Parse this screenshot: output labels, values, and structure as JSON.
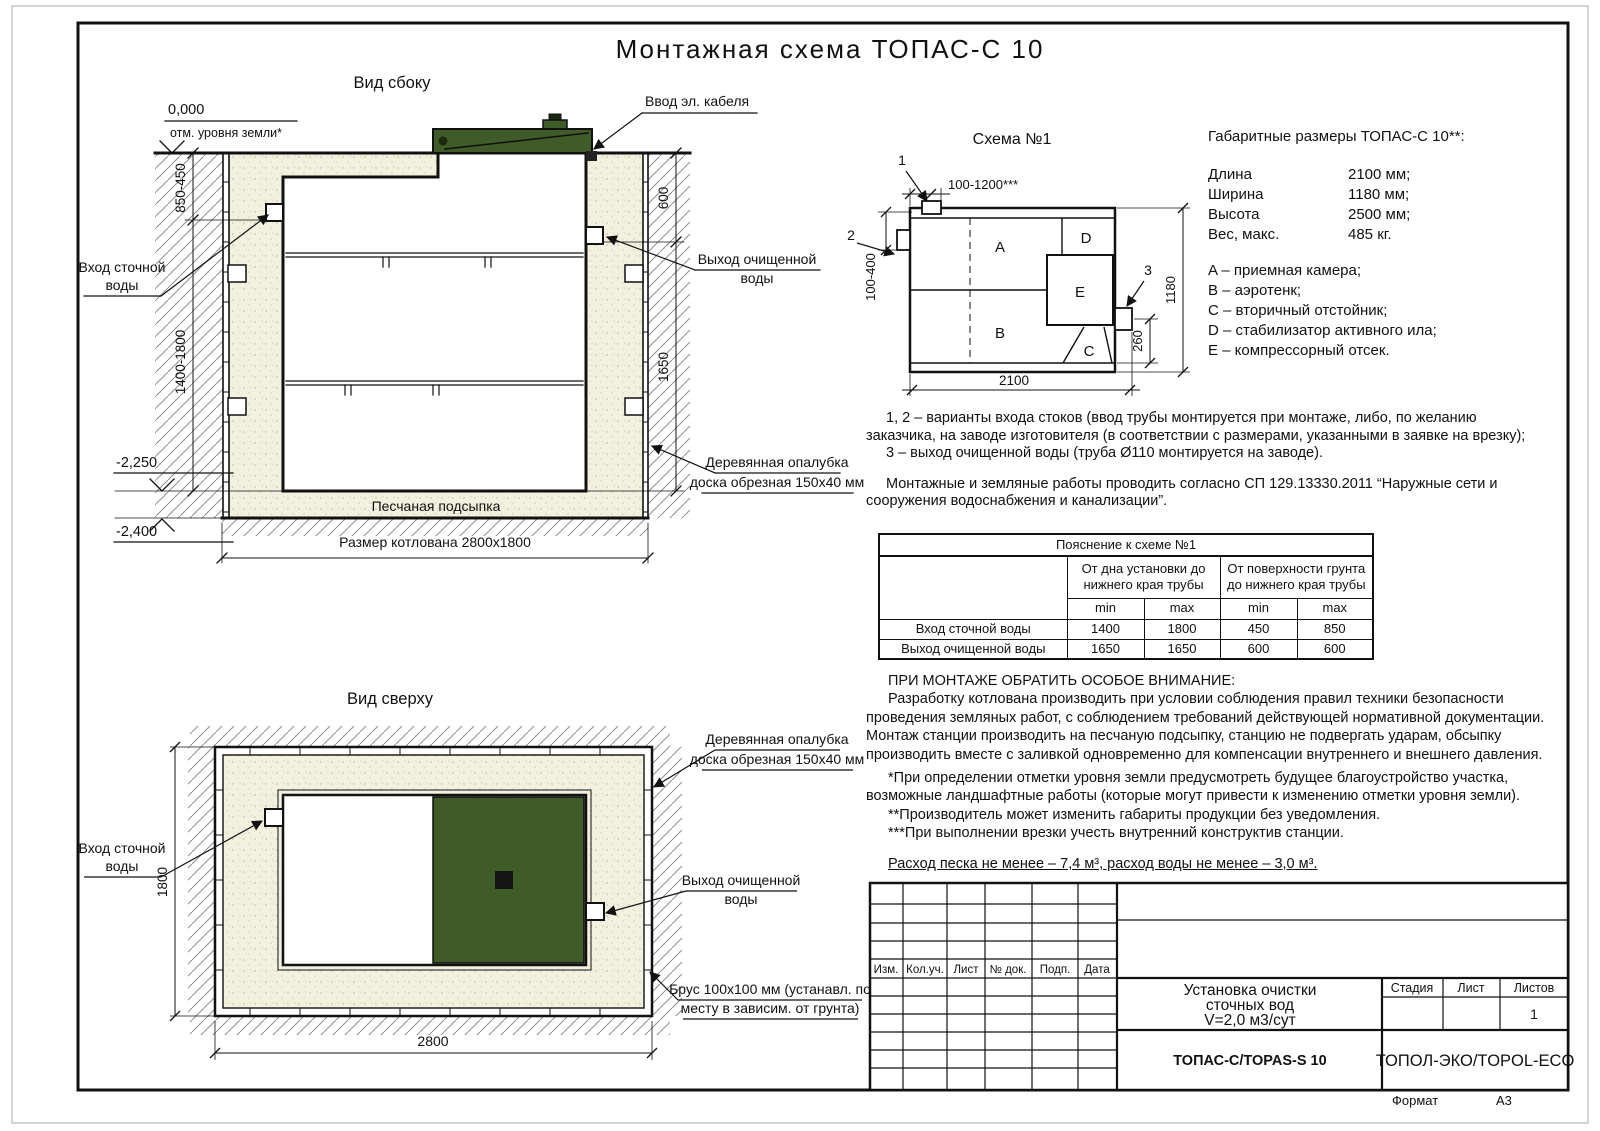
{
  "sheet": {
    "title": "Монтажная схема ТОПАС-С 10",
    "format_label": "Формат",
    "format_value": "А3"
  },
  "sv": {
    "title": "Вид сбоку",
    "elev0": "0,000",
    "elev0_note": "отм. уровня земли*",
    "dim_inlet": "850-450",
    "dim_body": "1400-1800",
    "elev_sand": "-2,250",
    "elev_pit": "-2,400",
    "dim600": "600",
    "dim1650": "1650",
    "inlet1": "Вход сточной",
    "inlet2": "воды",
    "cable": "Ввод эл. кабеля",
    "outlet1": "Выход очищенной",
    "outlet2": "воды",
    "formwork1": "Деревянная опалубка",
    "formwork2": "доска обрезная 150x40 мм",
    "sand": "Песчаная подсыпка",
    "pit": "Размер котлована 2800x1800"
  },
  "tv": {
    "title": "Вид сверху",
    "inlet1": "Вход сточной",
    "inlet2": "воды",
    "formwork1": "Деревянная опалубка",
    "formwork2": "доска обрезная 150x40 мм",
    "outlet1": "Выход очищенной",
    "outlet2": "воды",
    "beam1": "Брус 100x100 мм (устанавл. по",
    "beam2": "месту в зависим. от грунта)",
    "dim1800": "1800",
    "dim2800": "2800"
  },
  "sc": {
    "title": "Схема №1",
    "m1": "1",
    "m2": "2",
    "m3": "3",
    "dtop": "100-1200***",
    "dleft": "100-400",
    "dbottom": "2100",
    "dright": "1180",
    "d260": "260",
    "a": "A",
    "b": "B",
    "c": "C",
    "d": "D",
    "e": "E"
  },
  "specs": {
    "title": "Габаритные размеры ТОПАС-С 10**:",
    "rows": [
      {
        "label": "Длина",
        "value": "2100 мм;"
      },
      {
        "label": "Ширина",
        "value": "1180 мм;"
      },
      {
        "label": "Высота",
        "value": "2500 мм;"
      },
      {
        "label": "Вес, макс.",
        "value": "485 кг."
      }
    ],
    "legend": [
      "A – приемная камера;",
      "B – аэротенк;",
      "C – вторичный отстойник;",
      "D – стабилизатор активного ила;",
      "E – компрессорный отсек."
    ]
  },
  "notes": {
    "p1": "1, 2 – варианты входа  стоков (ввод трубы монтируется при монтаже, либо, по желанию заказчика, на заводе изготовителя (в соответствии с размерами, указанными в заявке на врезку);",
    "p2": "3 – выход очищенной воды (труба Ø110 монтируется на заводе).",
    "p3": "Монтажные и земляные работы проводить согласно СП 129.13330.2011 “Наружные сети и сооружения водоснабжения и канализации”."
  },
  "attention": {
    "title": "ПРИ МОНТАЖЕ ОБРАТИТЬ ОСОБОЕ ВНИМАНИЕ:",
    "p1": "Разработку котлована производить при условии соблюдения правил техники безопасности проведения земляных работ, с соблюдением требований действующей нормативной документации. Монтаж станции производить на песчаную подсыпку, станцию не подвергать ударам, обсыпку производить вместе с заливкой одновременно для компенсации внутреннего и внешнего давления.",
    "s1": "*При определении отметки уровня земли предусмотреть будущее благоустройство участка, возможные ландшафтные работы (которые могут привести к изменению отметки уровня земли).",
    "s2": "**Производитель может изменить габариты продукции без уведомления.",
    "s3": "***При выполнении врезки учесть внутренний конструктив станции.",
    "consumption": "Расход песка не менее – 7,4 м³, расход воды не менее – 3,0 м³."
  },
  "pipe_table": {
    "title": "Пояснение к схеме №1",
    "g1": "От дна установки до нижнего края трубы",
    "g2": "От поверхности грунта до нижнего края трубы",
    "min": "min",
    "max": "max",
    "rows": [
      {
        "name": "Вход сточной воды",
        "c": [
          "1400",
          "1800",
          "450",
          "850"
        ]
      },
      {
        "name": "Выход очищенной воды",
        "c": [
          "1650",
          "1650",
          "600",
          "600"
        ]
      }
    ]
  },
  "stamp": {
    "izm": "Изм.",
    "koluch": "Кол.уч.",
    "list": "Лист",
    "ndok": "№ док.",
    "podp": "Подп.",
    "data": "Дата",
    "t1": "Установка очистки",
    "t2": "сточных вод",
    "t3": "V=2,0 м3/сут",
    "model": "ТОПАС-С/TOPAS-S 10",
    "stage": "Стадия",
    "sheet": "Лист",
    "sheets": "Листов",
    "sheets_n": "1",
    "company": "ТОПОЛ-ЭКО/TOPOL-ECO"
  },
  "colors": {
    "lid_green": "#3e5b28",
    "sand_base": "#f2f0de",
    "line": "#111111"
  }
}
